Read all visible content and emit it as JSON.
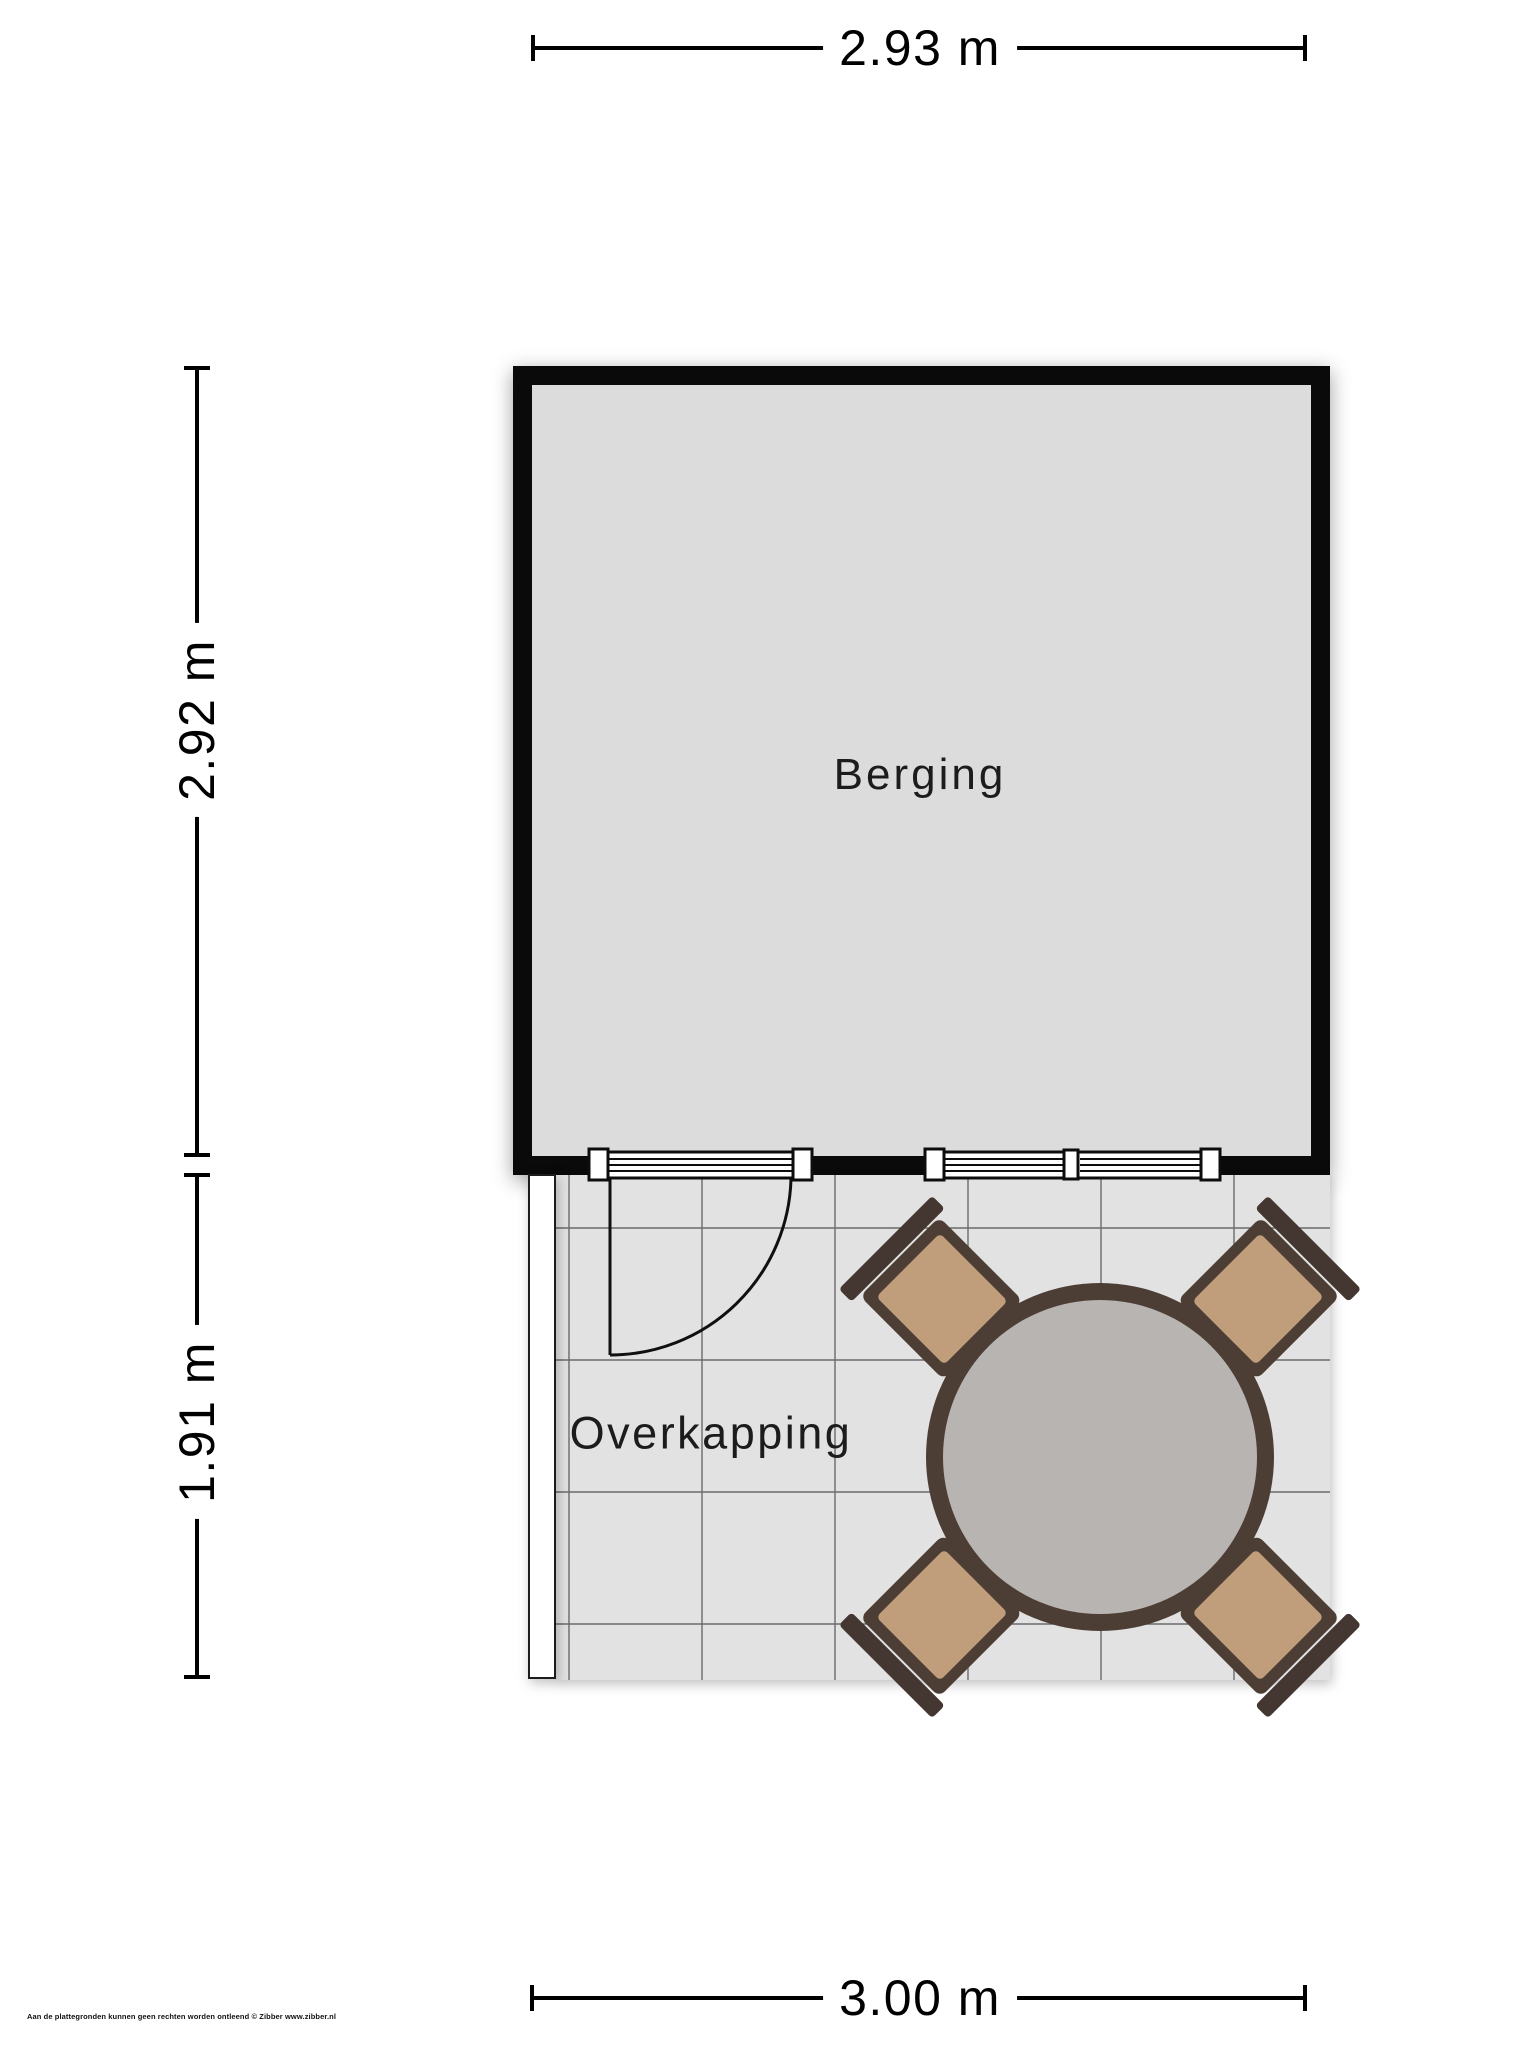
{
  "dimensions": {
    "top": "2.93 m",
    "side_upper": "2.92 m",
    "side_lower": "1.91 m",
    "bottom": "3.00 m"
  },
  "rooms": {
    "berging": {
      "label": "Berging"
    },
    "overkapping": {
      "label": "Overkapping"
    }
  },
  "furniture": {
    "table": "round-garden-table",
    "chair_count": 4
  },
  "features": {
    "glazed_door": "glazed door with swing arc",
    "double_window": "double window",
    "open_side_marker": "open side post (overkapping)"
  },
  "footer": {
    "disclaimer": "Aan de plattegronden kunnen geen rechten worden ontleend © Zibber www.zibber.nl"
  },
  "colors": {
    "background": "#ffffff",
    "wall": "#0a0a0a",
    "berging_floor": "#dcdcdc",
    "overkapping_floor": "#e2e2e2",
    "tile_line": "#6b6b6b",
    "table_top": "#b7b4b1",
    "furniture_frame": "#4c3d35",
    "chair_cushion": "#c19e7b"
  }
}
